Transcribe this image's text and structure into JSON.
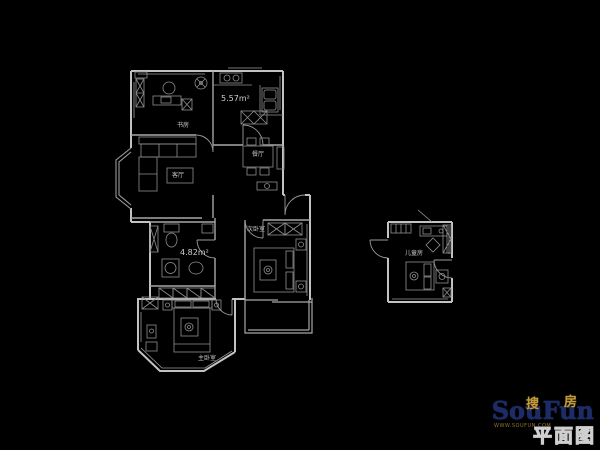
{
  "colors": {
    "background": "#000000",
    "wall_line": "#c2c2c2",
    "interior_line": "#a8a8a8",
    "furniture_line": "#8f8f8f",
    "label_text": "#c6c6c6",
    "brand_navy": "#1c2c6b",
    "brand_gold": "#c29a3e"
  },
  "rooms": {
    "study": {
      "label": "书房"
    },
    "kitchen": {
      "area_label": "5.57m²"
    },
    "dining": {
      "label": "餐厅"
    },
    "living": {
      "label": "客厅"
    },
    "bathroom": {
      "area_label": "4.82m²"
    },
    "secondary_bedroom": {
      "label": "次卧室"
    },
    "master_bedroom": {
      "label": "主卧室"
    },
    "kids_room": {
      "label": "儿童房"
    }
  },
  "watermark": {
    "brand_en": "SouFun",
    "brand_cn_first": "搜",
    "brand_cn_second": "房",
    "caption": "平面图",
    "url": "WWW.SOUFUN.COM"
  }
}
